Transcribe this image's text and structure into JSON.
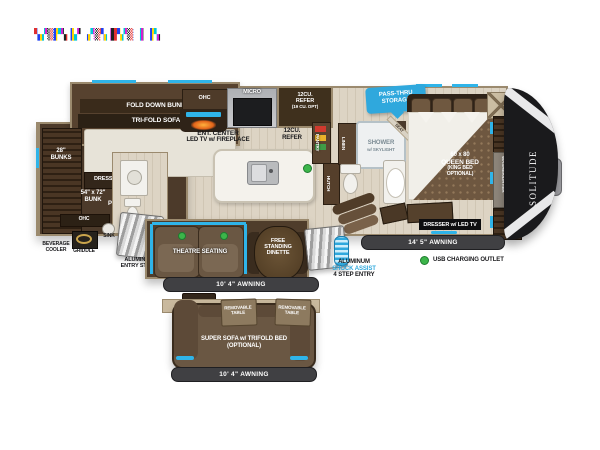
{
  "glitch": {
    "text": "▚▞▒▛▚▐▞ ▞▒▚▐▛▞▒ ▌▐▚"
  },
  "bunk": {
    "fold_down_bunk": "FOLD DOWN BUNK",
    "tri_fold_sofa": "TRI-FOLD SOFA",
    "bunks1": "28\"",
    "bunks2": "BUNKS",
    "dresser": "DRESSER",
    "size1": "54\" x 72\"",
    "size2": "BUNK",
    "tv1": "TV",
    "tv2": "PREP",
    "ohc": "OHC"
  },
  "ext_left": {
    "bev1": "BEVERAGE",
    "bev2": "COOLER",
    "griddle": "GRIDDLE",
    "sink": "SINK",
    "steps1": "ALUMINUM",
    "steps2": "ENTRY STEPS"
  },
  "kitchen": {
    "ohc": "OHC",
    "micro": "MICRO",
    "refer1": "12CU.",
    "refer2": "REFER",
    "refer_opt": "(19 CU. OPT)",
    "ent1": "ENT. CENTER",
    "ent2": "LED TV w/ FIREPLACE",
    "refer_floor1": "12CU.",
    "refer_floor2": "REFER",
    "pantry": "PANTRY",
    "hutch": "HUTCH"
  },
  "bath": {
    "linen": "LINEN",
    "shower1": "SHOWER",
    "shower2": "w/ SKYLIGHT",
    "seat": "SEAT"
  },
  "bed": {
    "pass1": "PASS-THRU",
    "pass2": "STORAGE",
    "b1": "60 x 80",
    "b2": "QUEEN BED",
    "b3": "(KING BED",
    "b4": "OPTIONAL)",
    "wd1": "WASHER/DRYER",
    "wd2": "PREP",
    "dresser_tv": "DRESSER w/ LED TV",
    "brand": "SOLITUDE"
  },
  "living": {
    "theatre": "THEATRE SEATING",
    "din1": "FREE",
    "din2": "STANDING",
    "din3": "DINETTE"
  },
  "ext_right": {
    "awning145": "14' 5\" AWNING",
    "usb": "USB CHARGING OUTLET",
    "shock1": "ALUMINUM",
    "shock2": "SHOCK ASSIST",
    "shock3": "4 STEP ENTRY"
  },
  "awnings": {
    "main104": "10' 4\" AWNING",
    "opt104": "10' 4\" AWNING"
  },
  "optional": {
    "rt1": "REMOVABLE",
    "rt2": "TABLE",
    "sofa1": "SUPER SOFA w/ TRIFOLD BED",
    "sofa2": "(OPTIONAL)"
  },
  "colors": {
    "accent_blue": "#2fb4e9",
    "usb_green": "#3cb54a",
    "awning_dark": "#404043"
  }
}
